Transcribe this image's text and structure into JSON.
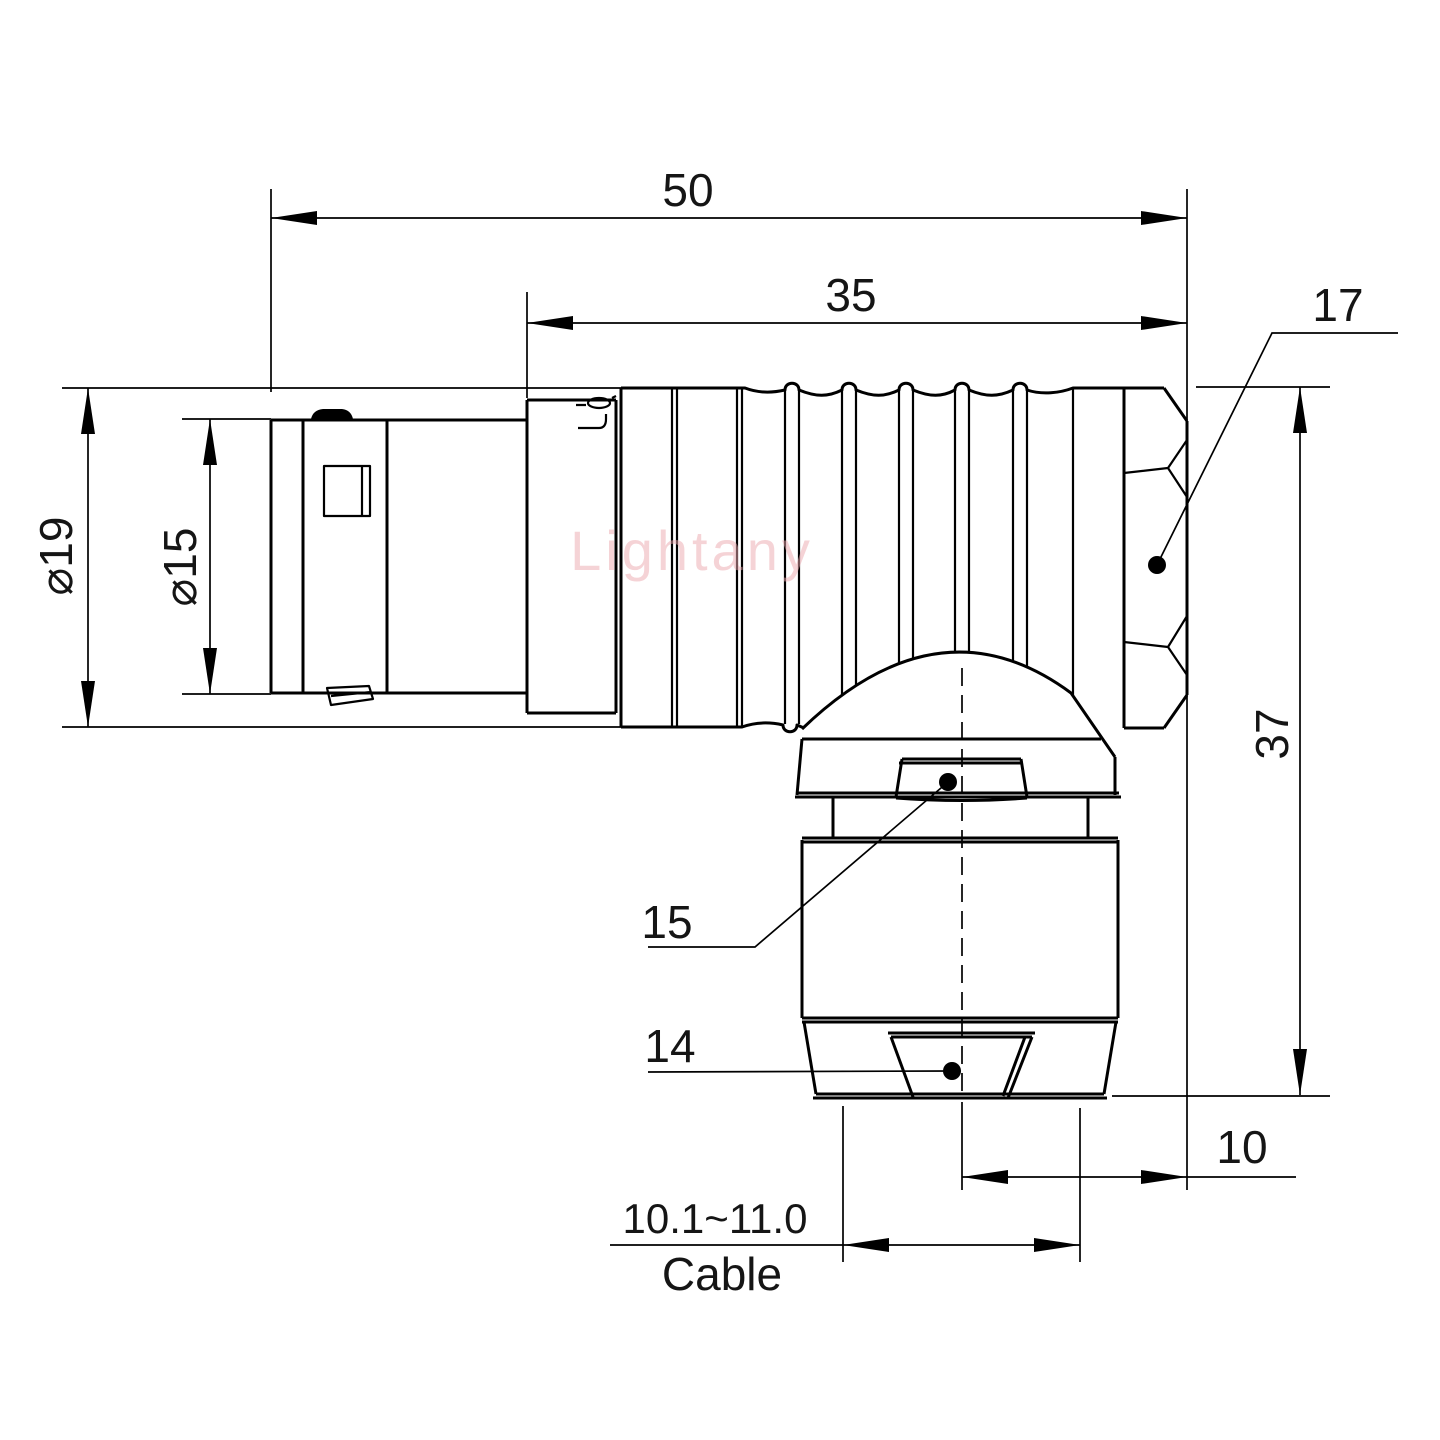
{
  "watermark": "Lightany",
  "labels": {
    "overall_length": "50",
    "front_length": "35",
    "hex_flat": "17",
    "outer_dia": "⌀19",
    "front_dia": "⌀15",
    "height": "37",
    "gland_dia": "15",
    "collet_dia": "14",
    "offset": "10",
    "cable_range": "10.1~11.0",
    "cable_word": "Cable"
  }
}
